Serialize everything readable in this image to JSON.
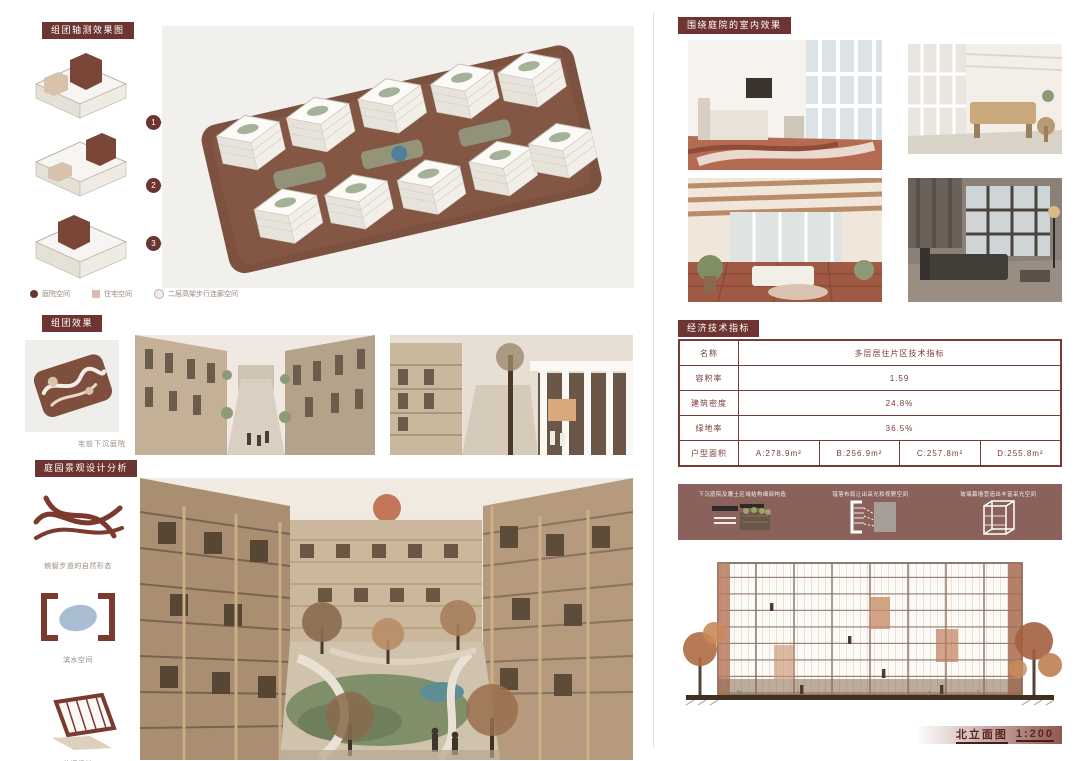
{
  "board": {
    "accent": "#6e3431",
    "table_border": "#7a3a36",
    "banner_bg": "#8a625b"
  },
  "left": {
    "axon": {
      "tag": "组团轴测效果图",
      "markers": [
        {
          "num": "1"
        },
        {
          "num": "2"
        },
        {
          "num": "3"
        }
      ],
      "legend": [
        {
          "label": "庭院空间"
        },
        {
          "label": "住宅空间"
        },
        {
          "label": "二层高架步行连廊空间"
        }
      ]
    },
    "effect": {
      "tag": "组团效果",
      "plan_caption": "宅前下沉庭院"
    },
    "landscape": {
      "tag": "庭园景观设计分析",
      "items": [
        {
          "label": "蜿蜒步道的自然形态"
        },
        {
          "label": "滨水空间"
        },
        {
          "label": "休闲场地"
        }
      ]
    }
  },
  "right": {
    "interior": {
      "tag": "围绕庭院的室内效果"
    },
    "indicators": {
      "tag": "经济技术指标",
      "table": {
        "rows": [
          {
            "label": "名称",
            "values": [
              "多层居住片区技术指标"
            ]
          },
          {
            "label": "容积率",
            "values": [
              "1.59"
            ]
          },
          {
            "label": "建筑密度",
            "values": [
              "24.8%"
            ]
          },
          {
            "label": "绿地率",
            "values": [
              "36.5%"
            ]
          },
          {
            "label": "户型面积",
            "values": [
              "A:278.9m²",
              "B:256.9m²",
              "C:257.8m²",
              "D:255.8m²"
            ]
          }
        ]
      }
    },
    "elevation": {
      "banner": [
        {
          "caption": "下沉庭院及覆土区域结构细部构造"
        },
        {
          "caption": "错落布局让出采光和视野空间"
        },
        {
          "caption": "玻璃幕墙营造出丰富采光空间"
        }
      ],
      "caption_title": "北立面图",
      "caption_scale": "1:200"
    }
  }
}
